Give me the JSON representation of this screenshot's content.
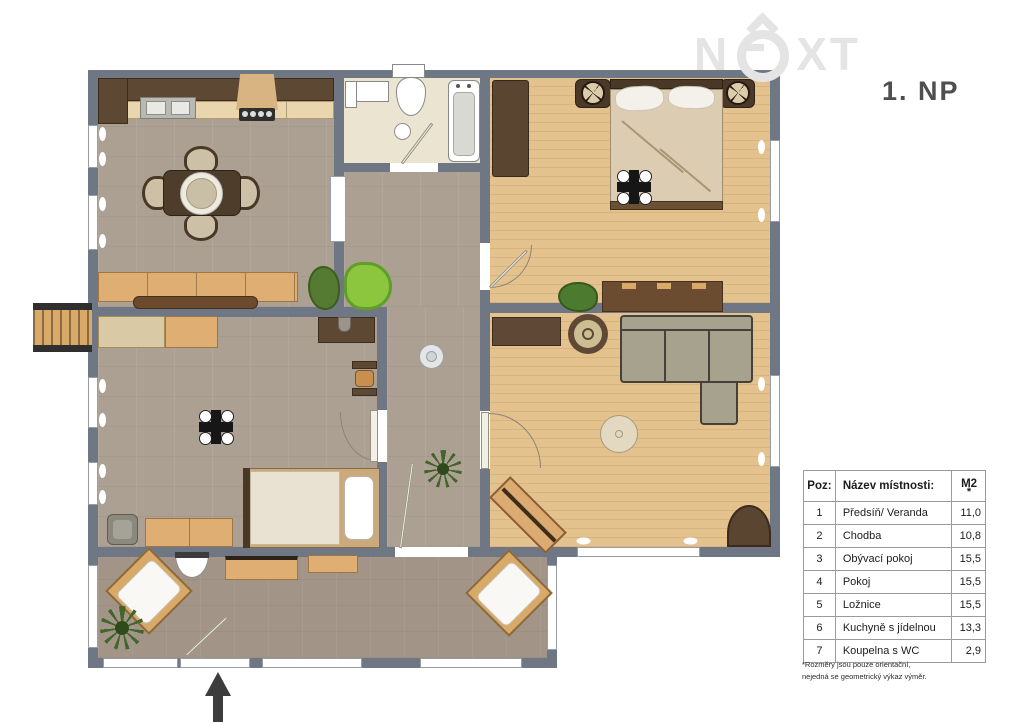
{
  "logo": {
    "prefix": "N",
    "suffix": "XT",
    "full_name": "NEXT"
  },
  "floor_label": "1. NP",
  "legend_table": {
    "col_poz": "Poz:",
    "col_name": "Název místnosti:",
    "col_area": "M2",
    "area_note_symbol": "*",
    "rows": [
      {
        "poz": "1",
        "name": "Předsíň/ Veranda",
        "m2": "11,0"
      },
      {
        "poz": "2",
        "name": "Chodba",
        "m2": "10,8"
      },
      {
        "poz": "3",
        "name": "Obývací pokoj",
        "m2": "15,5"
      },
      {
        "poz": "4",
        "name": "Pokoj",
        "m2": "15,5"
      },
      {
        "poz": "5",
        "name": "Ložnice",
        "m2": "15,5"
      },
      {
        "poz": "6",
        "name": "Kuchyně s jídelnou",
        "m2": "13,3"
      },
      {
        "poz": "7",
        "name": "Koupelna s WC",
        "m2": "2,9"
      }
    ]
  },
  "footnote": {
    "line1": "*Rozměry jsou pouze orientační,",
    "line2": "nejedná se geometrický výkaz výměr."
  },
  "colors": {
    "wall": "#6f7684",
    "carpet_floor": "#aca093",
    "wood_floor": "#e4c28e",
    "bath_floor": "#ebe4d1",
    "veranda_floor": "#a29487",
    "accent_plant": "#8cc63e",
    "logo_gray": "#e4e4e4"
  }
}
